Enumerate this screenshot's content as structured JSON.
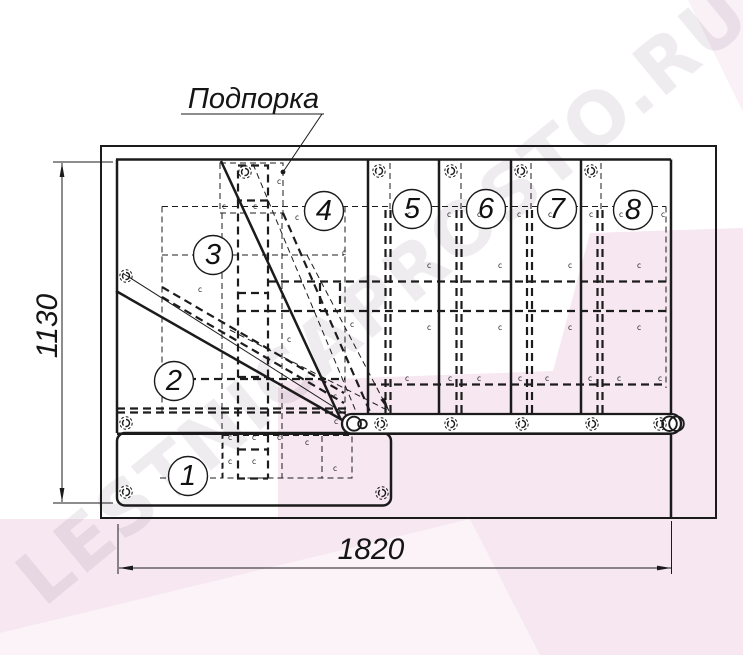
{
  "drawing": {
    "type": "staircase-plan-top-view",
    "support_label": "Подпорка",
    "dimensions": {
      "height_mm": "1130",
      "width_mm": "1820"
    },
    "steps": [
      "1",
      "2",
      "3",
      "4",
      "5",
      "6",
      "7",
      "8"
    ],
    "glyphs": {
      "rivet_mark": "c"
    },
    "icons": [
      "bolt-icon",
      "rivet-mark",
      "leader-dot",
      "dimension-arrow"
    ],
    "colors": {
      "line": "#1b1b1b",
      "pink_band": "#f6e7f1",
      "pink_light": "#fbf3f8",
      "watermark_text_color": "#8a7485"
    }
  },
  "watermark": {
    "text": "LESTNICAPROSTO.RU"
  }
}
